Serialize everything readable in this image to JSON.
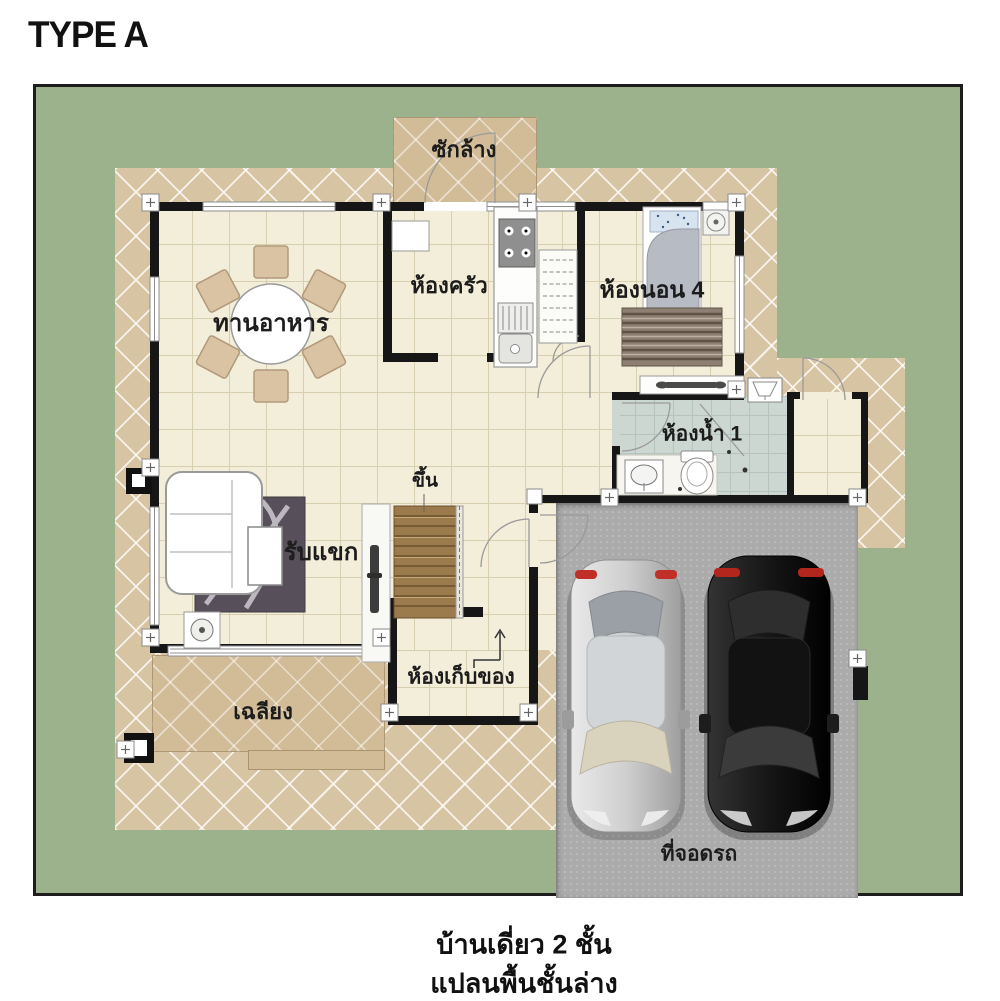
{
  "title": "TYPE A",
  "rooms": {
    "laundry": "ซักล้าง",
    "kitchen": "ห้องครัว",
    "bedroom4": "ห้องนอน 4",
    "dining": "ทานอาหาร",
    "bathroom1": "ห้องน้ำ 1",
    "living": "รับแขก",
    "stairs_up": "ขึ้น",
    "storage": "ห้องเก็บของ",
    "porch": "เฉลียง",
    "carport": "ที่จอดรถ"
  },
  "captions": {
    "line1": "บ้านเดี่ยว 2 ชั้น",
    "line2": "แปลนพื้นชั้นล่าง"
  },
  "colors": {
    "lawn": "#9cb28d",
    "walkway": "#d6c4a2",
    "porch": "#d2bc98",
    "floor": "#f2eed9",
    "bath_tile": "#ccd7d2",
    "wall": "#161616",
    "parking": "#ababab",
    "wood": "#9b7a4b",
    "car_silver": "#c9c9c9",
    "car_black": "#1a1a1a"
  }
}
